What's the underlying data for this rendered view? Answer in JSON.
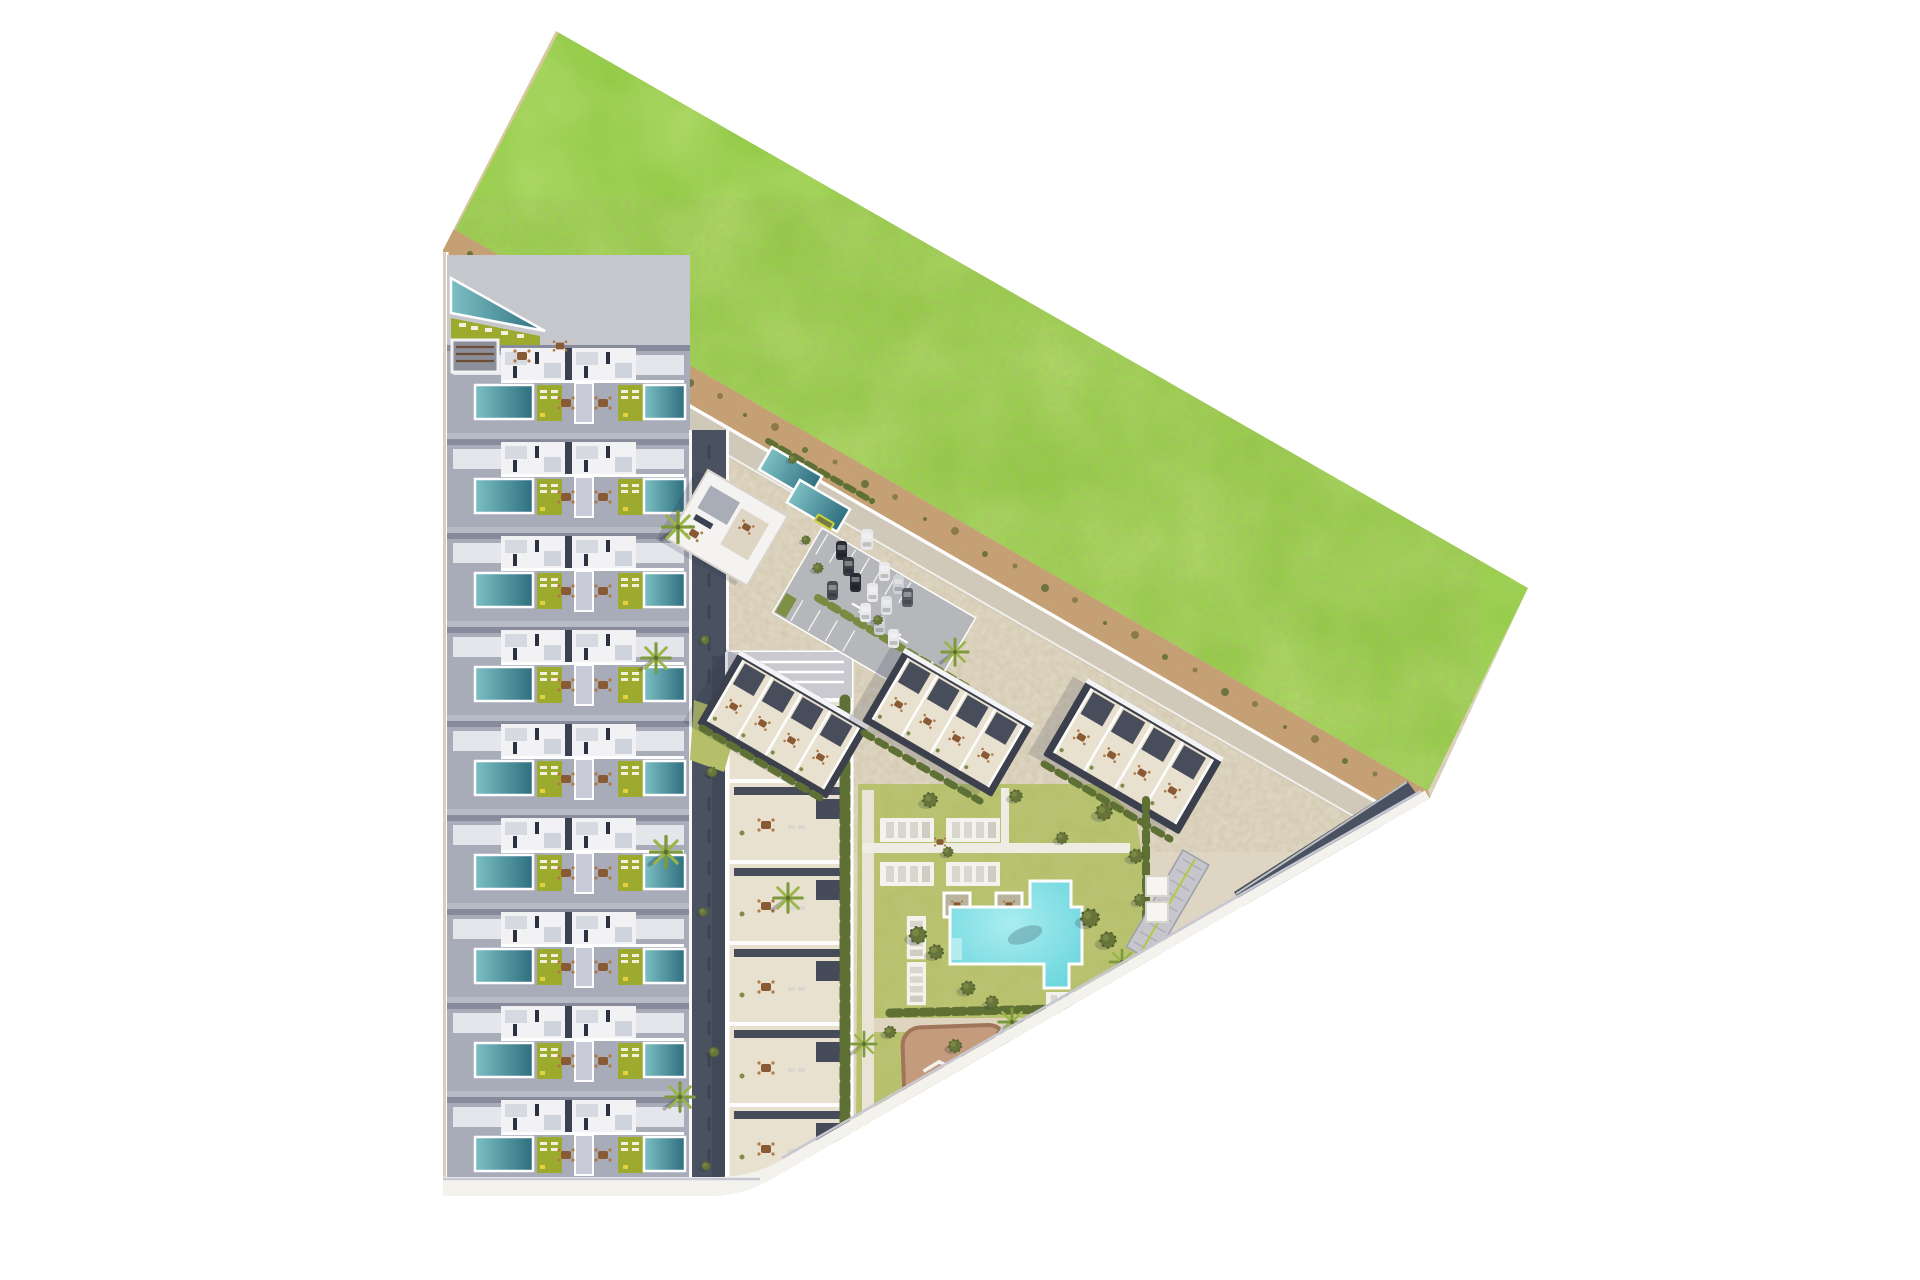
{
  "scene": {
    "label": "Aerial 3D architectural site plan of a residential development with townhouses, apartment blocks, communal pool, garden and parking",
    "type": "architectural-site-plan",
    "view": "top-down"
  },
  "palette": {
    "grass": "#8dc63f",
    "grass-light": "#a7d65c",
    "sand": "#c7a074",
    "sand-dark": "#8a7547",
    "plaza": "#ded5c2",
    "road": "#d0c9ba",
    "navy": "#4a5160",
    "concrete": "#a8acb8",
    "concrete-dark": "#878b9b",
    "roof-white": "#f2f2f4",
    "roof-dark": "#3b404c",
    "terrace": "#e9e1d0",
    "pool-deep": "#2e6e7e",
    "pool-light": "#7cc0c4",
    "big-pool": "#5bd0d9",
    "big-pool-light": "#a9edef",
    "lawn-strip": "#9cab2e",
    "lawn": "#b5bf69",
    "hedge": "#5f7035",
    "tree": "#67743a",
    "palm": "#7d9a3c",
    "sidewalk": "#d9cdb8",
    "playground": "#c59b7d",
    "playground-border": "#a0755a",
    "curb": "#f4f2ec",
    "bottom-road": "#d5d5e1",
    "car-dark": "#2a2d33",
    "car-white": "#e9e9eb",
    "bus": "#ccd23e",
    "furniture": "#8a5a35"
  },
  "areas": {
    "green_field": {
      "label": "Undeveloped grass field"
    },
    "sand_path": {
      "label": "Perimeter sand path with shrubs"
    },
    "townhouse_strip": {
      "label": "Terraced townhouses with private pools",
      "rows": 9,
      "pools_per_row": 2
    },
    "apartment_blocks": {
      "label": "Angled apartment blocks with roof terraces",
      "count": 3
    },
    "linear_block": {
      "label": "Linear apartment block with roof terraces",
      "units": 6
    },
    "clubhouse": {
      "label": "Clubhouse with lap pools",
      "lap_pools": 2
    },
    "parking": {
      "label": "Surface parking lot",
      "cars": 13
    },
    "communal_garden": {
      "label": "Communal garden with sun decks"
    },
    "main_pool": {
      "label": "Communal swimming pool"
    },
    "playground": {
      "label": "Children playground"
    },
    "roads": {
      "label": "Internal access roads"
    }
  }
}
